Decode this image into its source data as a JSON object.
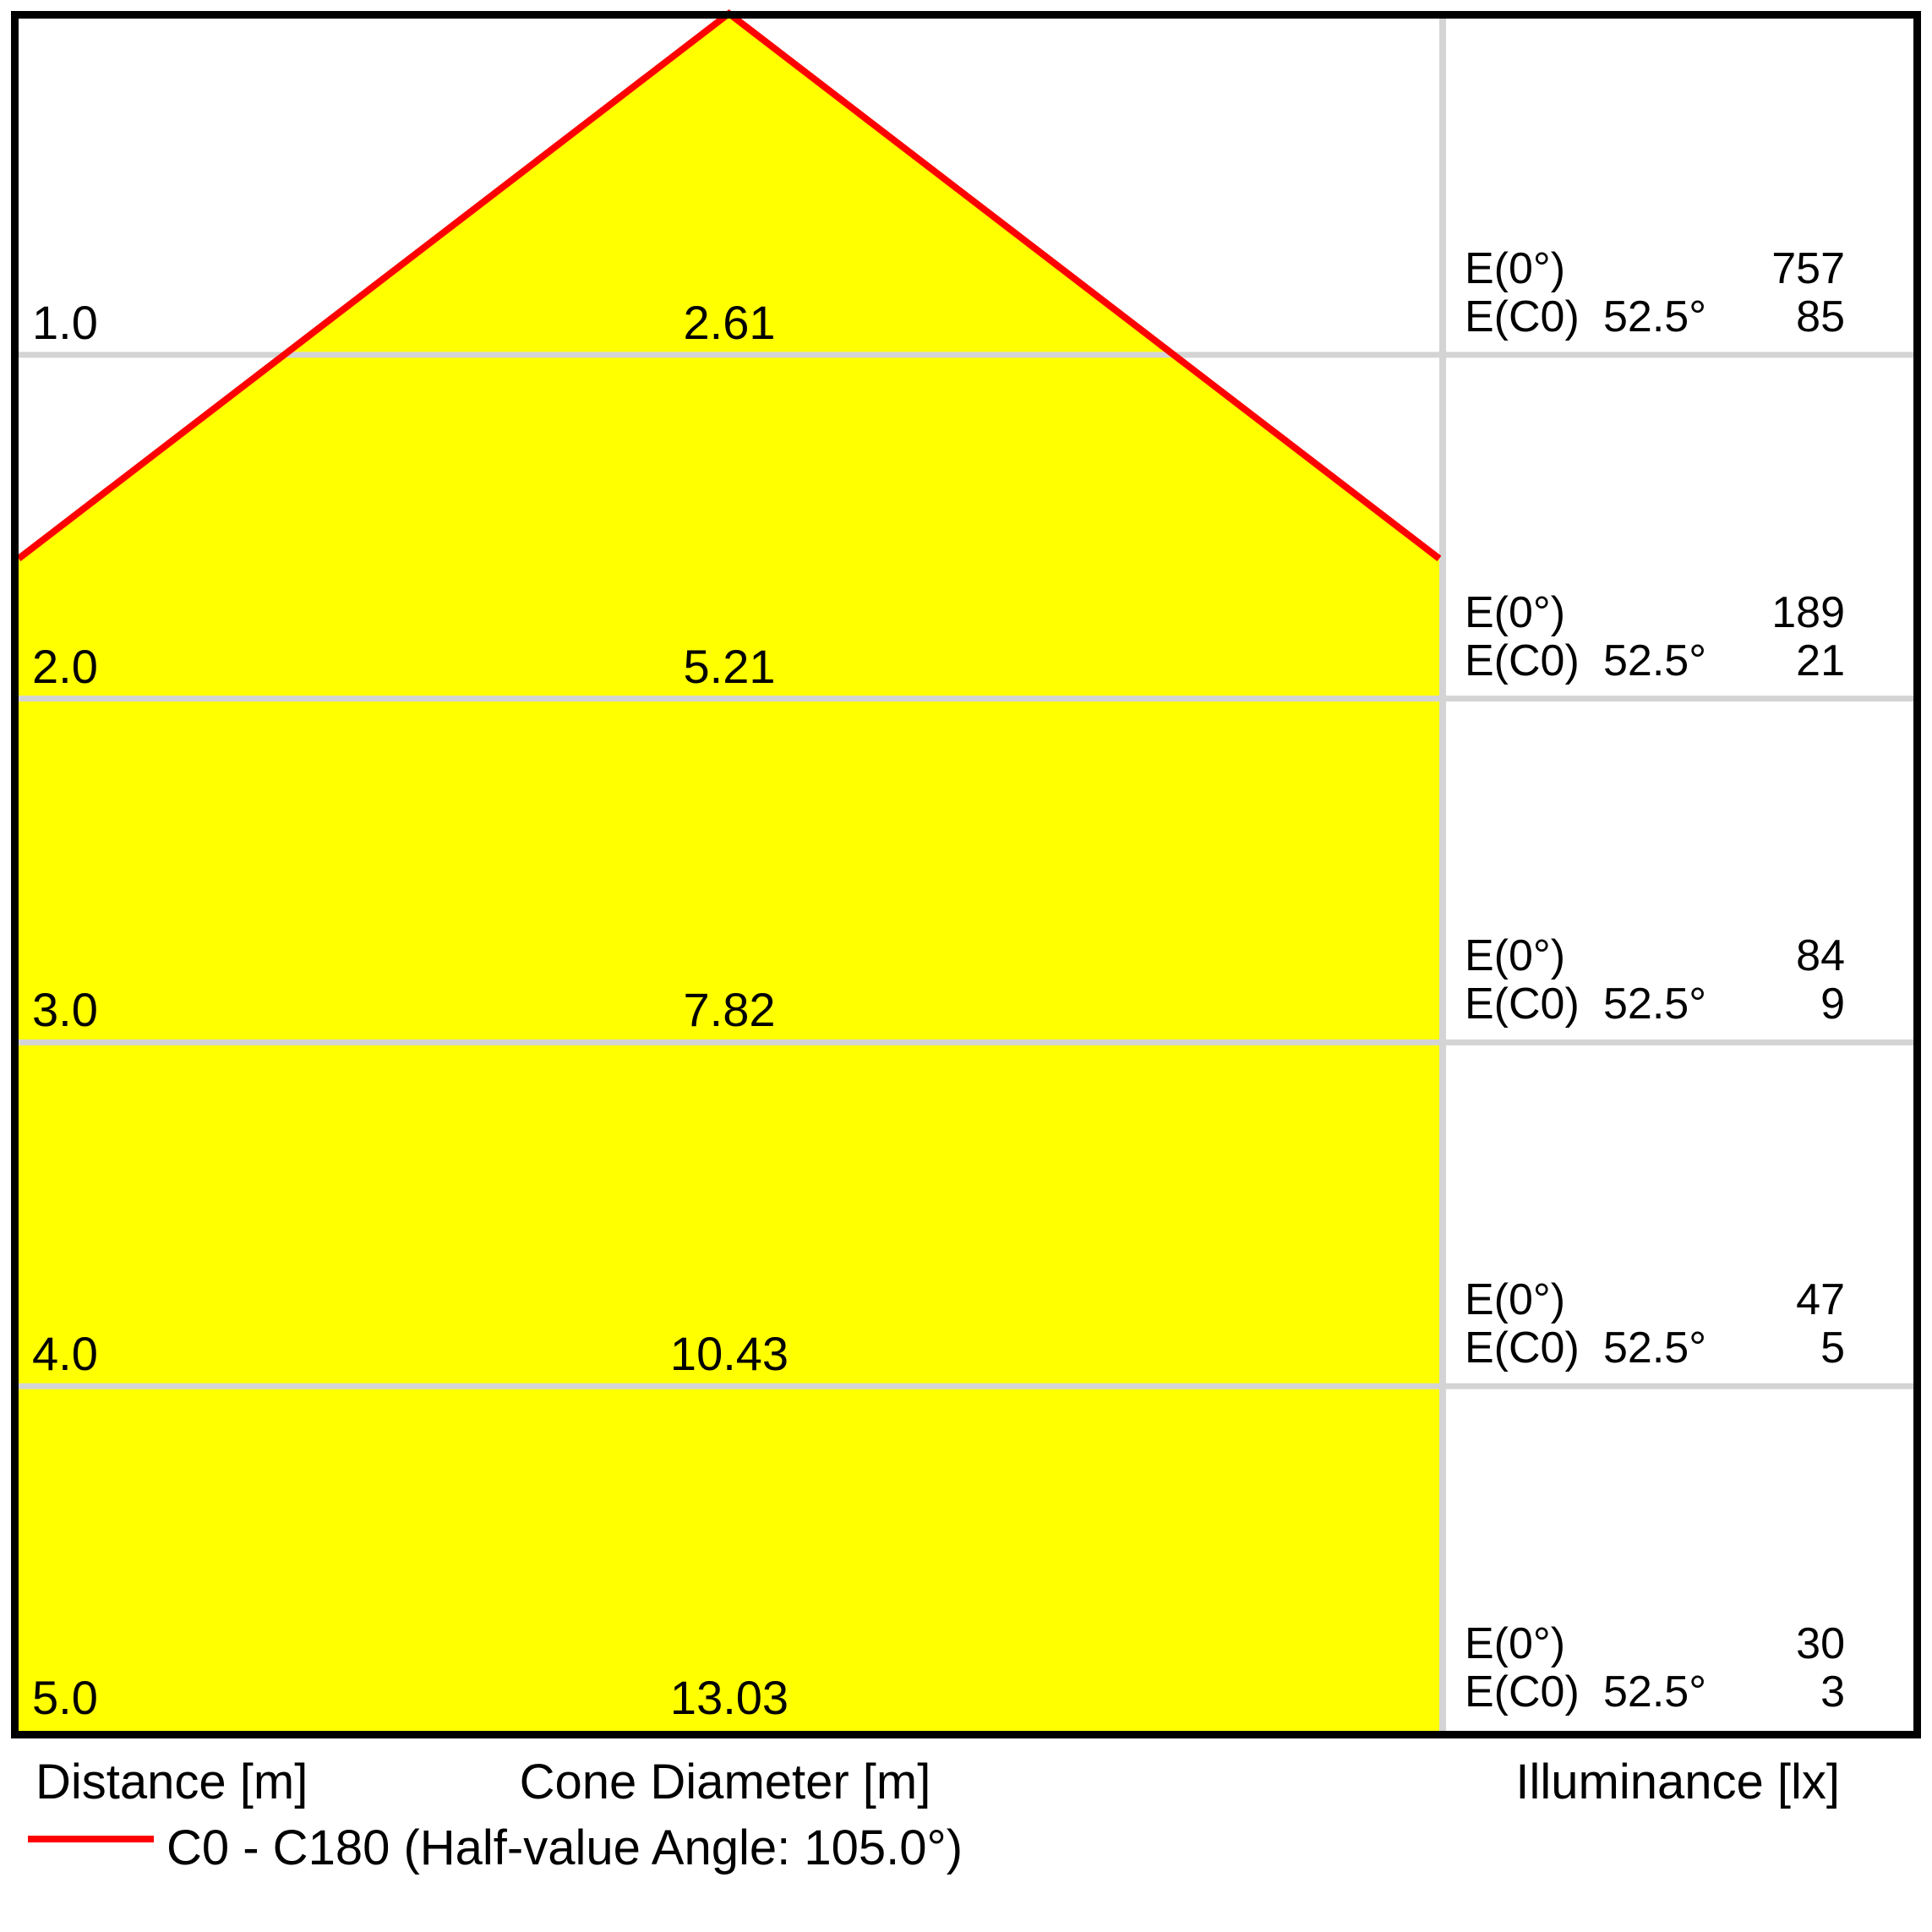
{
  "chart_data": {
    "type": "area",
    "subtype": "photometric-light-cone-diagram",
    "columns": {
      "distance": "Distance [m]",
      "cone_diameter": "Cone Diameter [m]",
      "illuminance": "Illuminance [lx]"
    },
    "distances_m": [
      1.0,
      2.0,
      3.0,
      4.0,
      5.0
    ],
    "cone_diameters_m": [
      2.61,
      5.21,
      7.82,
      10.43,
      13.03
    ],
    "e0_lx": [
      757,
      189,
      84,
      47,
      30
    ],
    "ec0_lx": [
      85,
      21,
      9,
      5,
      3
    ],
    "ec0_angle_deg": 52.5,
    "half_value_angle_deg": 105.0,
    "legend_label": "C0 - C180 (Half-value Angle: 105.0°)",
    "series_color": "#ff0000",
    "cone_fill": "#ffff00",
    "grid_color": "#d4d4d4",
    "rows": [
      {
        "distance": "1.0",
        "diameter": "2.61",
        "e0_label": "E(0°)",
        "e0_value": "757",
        "ec0_label": "E(C0)",
        "ec0_angle": "52.5°",
        "ec0_value": "85"
      },
      {
        "distance": "2.0",
        "diameter": "5.21",
        "e0_label": "E(0°)",
        "e0_value": "189",
        "ec0_label": "E(C0)",
        "ec0_angle": "52.5°",
        "ec0_value": "21"
      },
      {
        "distance": "3.0",
        "diameter": "7.82",
        "e0_label": "E(0°)",
        "e0_value": "84",
        "ec0_label": "E(C0)",
        "ec0_angle": "52.5°",
        "ec0_value": "9"
      },
      {
        "distance": "4.0",
        "diameter": "10.43",
        "e0_label": "E(0°)",
        "e0_value": "47",
        "ec0_label": "E(C0)",
        "ec0_angle": "52.5°",
        "ec0_value": "5"
      },
      {
        "distance": "5.0",
        "diameter": "13.03",
        "e0_label": "E(0°)",
        "e0_value": "30",
        "ec0_label": "E(C0)",
        "ec0_angle": "52.5°",
        "ec0_value": "3"
      }
    ]
  },
  "footer": {
    "distance_label": "Distance [m]",
    "cone_diameter_label": "Cone Diameter [m]",
    "illuminance_label": "Illuminance [lx]",
    "legend_label": "C0 - C180 (Half-value Angle: 105.0°)"
  }
}
